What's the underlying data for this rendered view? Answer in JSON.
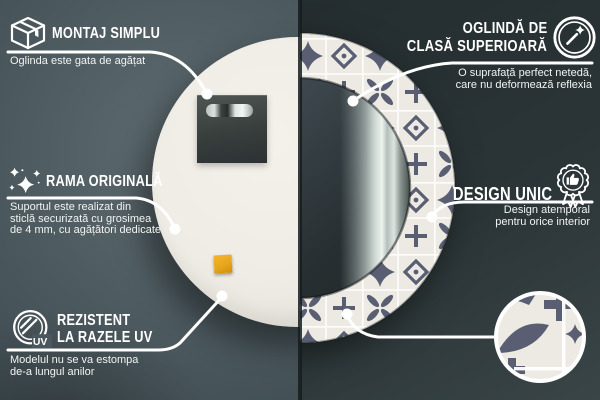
{
  "colors": {
    "bg_left_light": "#5f6d72",
    "bg_left_mid": "#4a575c",
    "bg_left_dark": "#3b474c",
    "bg_right_dark": "#242d2f",
    "bg_right_light": "#3a4547",
    "seam": "#151c1e",
    "mirror_back": "#efece5",
    "plate_dark": "#383e3c",
    "sticker_orange": "#e8a61e",
    "pattern_base": "#edeae3",
    "pattern_slate": "#5a5e73",
    "glass_dark": "#2b3436",
    "accent_white": "#ffffff"
  },
  "callouts": {
    "montaj": {
      "icon": "package-box-icon",
      "title": "MONTAJ SIMPLU",
      "subtitle": "Oglinda este gata de agățat"
    },
    "rama": {
      "icon": "sparkles-icon",
      "title": "RAMA ORIGINALĂ",
      "subtitle_lines": [
        "Suportul este realizat din",
        "sticlă securizată cu grosimea",
        "de 4 mm, cu agățători dedicate"
      ]
    },
    "uv": {
      "icon": "uv-protection-icon",
      "uv_label": "UV",
      "title_lines": [
        "REZISTENT",
        "LA RAZELE UV"
      ],
      "subtitle_lines": [
        "Modelul nu se va estompa",
        "de-a lungul anilor"
      ]
    },
    "oglinda": {
      "icon": "mirror-shine-icon",
      "title_lines": [
        "OGLINDĂ DE",
        "CLASĂ SUPERIOARĂ"
      ],
      "subtitle_lines": [
        "O suprafață perfect netedă,",
        "care nu deformează reflexia"
      ]
    },
    "design": {
      "icon": "award-badge-icon",
      "title": "DESIGN UNIC",
      "subtitle_lines": [
        "Design atemporal",
        "pentru orice interior"
      ]
    }
  }
}
